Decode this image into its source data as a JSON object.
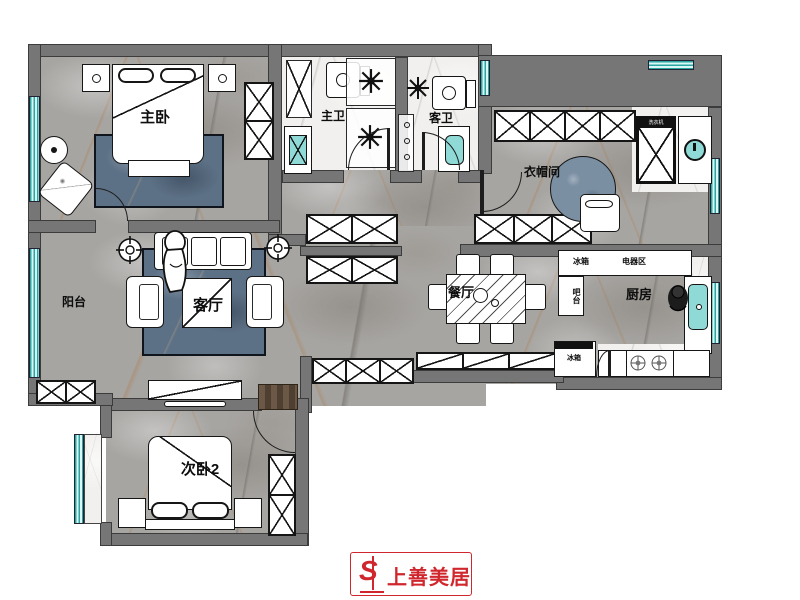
{
  "rooms": {
    "master_bedroom": "主卧",
    "master_bath": "主卫",
    "guest_bath": "客卫",
    "cloakroom": "衣帽间",
    "balcony": "阳台",
    "living_room": "客厅",
    "dining_room": "餐厅",
    "kitchen": "厨房",
    "bedroom2": "次卧2"
  },
  "appliance_labels": {
    "washer": "洗衣机",
    "fridge_upper": "冰箱",
    "appliance_area": "电器区",
    "bar_counter": "吧台",
    "fridge_lower": "冰箱"
  },
  "logo": {
    "mark": "S",
    "brand": "上善美居"
  },
  "colors": {
    "wall": "#767676",
    "window_teal": "#8fd9d6",
    "rug_blue": "#5d7186",
    "floor_gray": "#a7a5a2",
    "floor_white": "#f1f0ee",
    "brand_red": "#d0272e"
  }
}
